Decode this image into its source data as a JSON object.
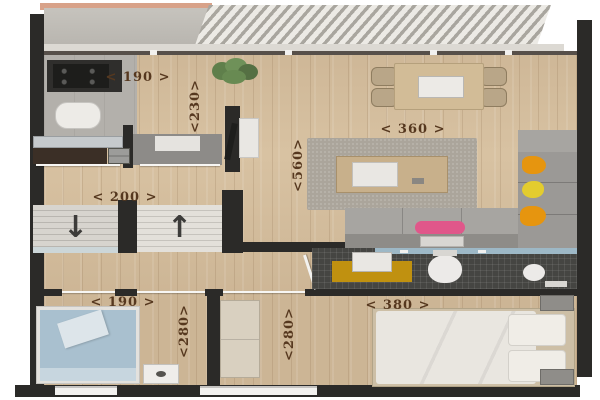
{
  "floorplan": {
    "dimension_labels": {
      "kitchen_width": "< 190 >",
      "kitchen_depth": "<230>",
      "living_width": "< 360 >",
      "living_depth": "<560>",
      "stairs_width": "< 200 >",
      "bedroom_left_width": "< 190 >",
      "bedroom_left_depth": "<280>",
      "bedroom_right_depth": "<280>",
      "bedroom_right_width": "< 380 >"
    },
    "stairs": {
      "down_arrow": "↓",
      "up_arrow": "↑"
    },
    "colors": {
      "wall": "#2b2a28",
      "wood_floor": "#d8c2a2",
      "kitchen_floor": "#b3b0ab",
      "bathroom_tile": "#454542",
      "dimension_text": "#56381f",
      "pillow_pink": "#e0578a",
      "pillow_orange": "#e6950f",
      "pillow_yellow": "#e3cc2e",
      "bed_blue": "#a9c0cf",
      "bath_mat_yellow": "#c09110",
      "balcony_edge_salmon": "#d8a289"
    }
  }
}
